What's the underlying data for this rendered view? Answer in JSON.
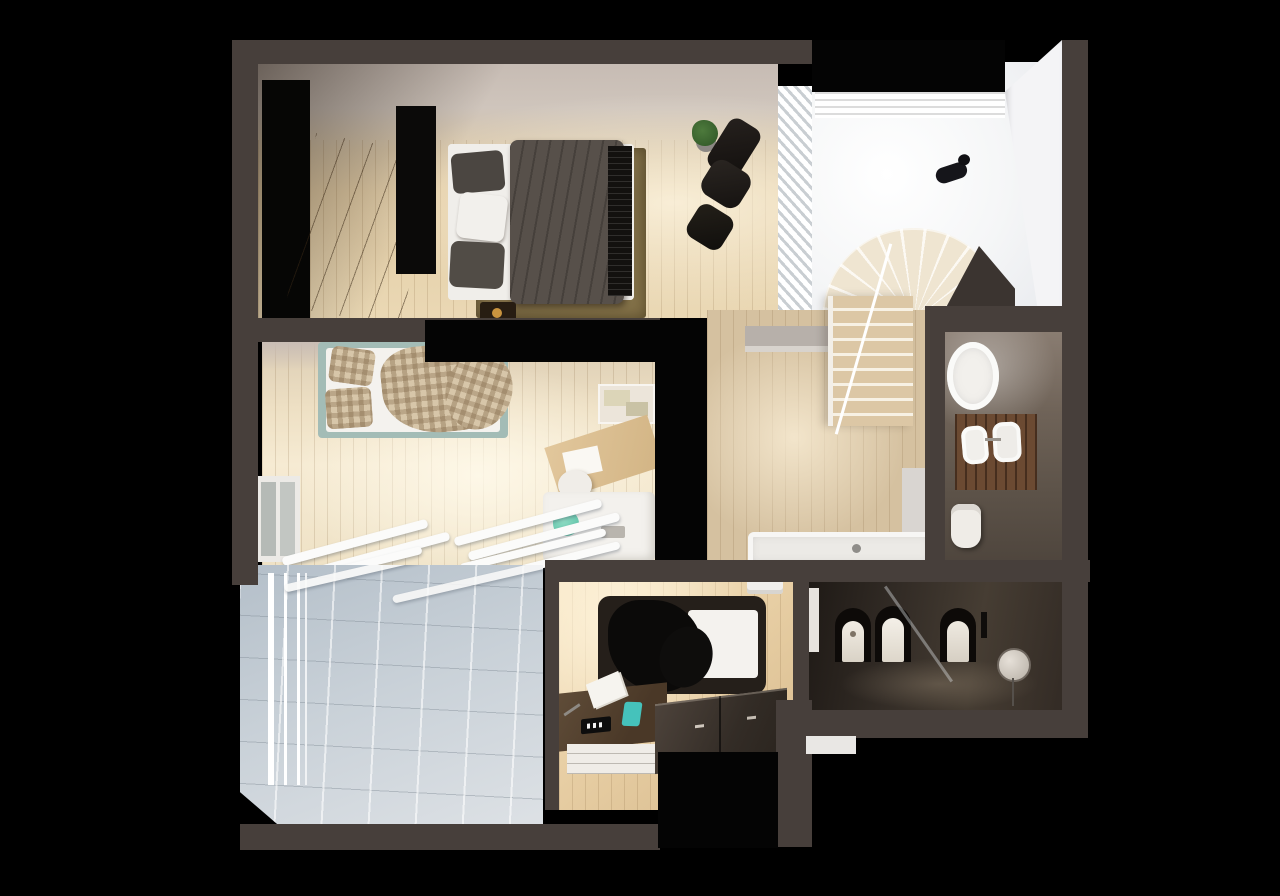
{
  "scene": {
    "type": "3d-floor-plan-render",
    "title": "Top-down 3D render of an apartment upper floor with bedrooms, bathrooms, stairwell and terrace",
    "view": "top-down cutaway",
    "background_color": "#000000",
    "visible_text": "none"
  },
  "palette": {
    "background": "#000000",
    "walls": "#473f3b",
    "warm_wood_floor": "#e3cda6",
    "pale_wood_floor": "#f3e7cd",
    "hall_wood_floor": "#d5c1a0",
    "terrace_tile": "#c6cfd7",
    "white_surfaces": "#f4f2ee",
    "duvet_grey": "#575049",
    "leather_black": "#171412",
    "bed_frame_teal": "#a3bcb6",
    "teal_accent": "#45c2bb",
    "vanity_wood": "#6b4a32",
    "stair_tread_wood": "#dcc7a5",
    "dark_bathroom": "#332c26",
    "rug_olive": "#87754d"
  },
  "rooms": [
    {
      "name": "master-bedroom",
      "label": "Master bedroom",
      "items": [
        "black wardrobe panel",
        "wooden dresser with drawers",
        "double bed with grey duvet",
        "grey and white pillows",
        "olive area rug",
        "black slatted foot bench",
        "bedside table",
        "black leather lounge chair",
        "ottoman",
        "potted plant",
        "louvered window screen"
      ]
    },
    {
      "name": "stair-landing",
      "label": "Stair landing and double-height void",
      "items": [
        "slatted skylight",
        "black cat lying on floor",
        "winder staircase fan",
        "straight stair flight",
        "white stair railing",
        "angled white wall"
      ]
    },
    {
      "name": "hallway",
      "label": "Hallway",
      "items": [
        "wood plank floor",
        "low storage cabinet",
        "built-in bathtub",
        "door to bathroom"
      ]
    },
    {
      "name": "ensuite-bathroom",
      "label": "En-suite bathroom",
      "items": [
        "oval freestanding bathtub",
        "twin basin wood vanity",
        "toilet"
      ]
    },
    {
      "name": "second-bedroom",
      "label": "Second bedroom",
      "items": [
        "bed with teal frame and checkered bedding",
        "wall shelf with boxes",
        "writing desk",
        "desk chair",
        "white sideboard cabinet",
        "teal towel",
        "side window",
        "white louver slats"
      ]
    },
    {
      "name": "terrace",
      "label": "Terrace",
      "items": [
        "large tiled floor",
        "white railing",
        "pergola slats"
      ]
    },
    {
      "name": "third-bedroom",
      "label": "Third bedroom",
      "items": [
        "single bed with black throw and white mattress",
        "desk with papers, alarm clock and teal phone",
        "white drawer front",
        "dark two-door wardrobe",
        "air-conditioning unit"
      ]
    },
    {
      "name": "dark-bathroom",
      "label": "Dark bathroom",
      "items": [
        "bidet in niche",
        "toilet in niche",
        "washbasin pedestal in niche",
        "round mirror on stand",
        "glass partition",
        "slim white cabinet",
        "outside step"
      ]
    }
  ]
}
